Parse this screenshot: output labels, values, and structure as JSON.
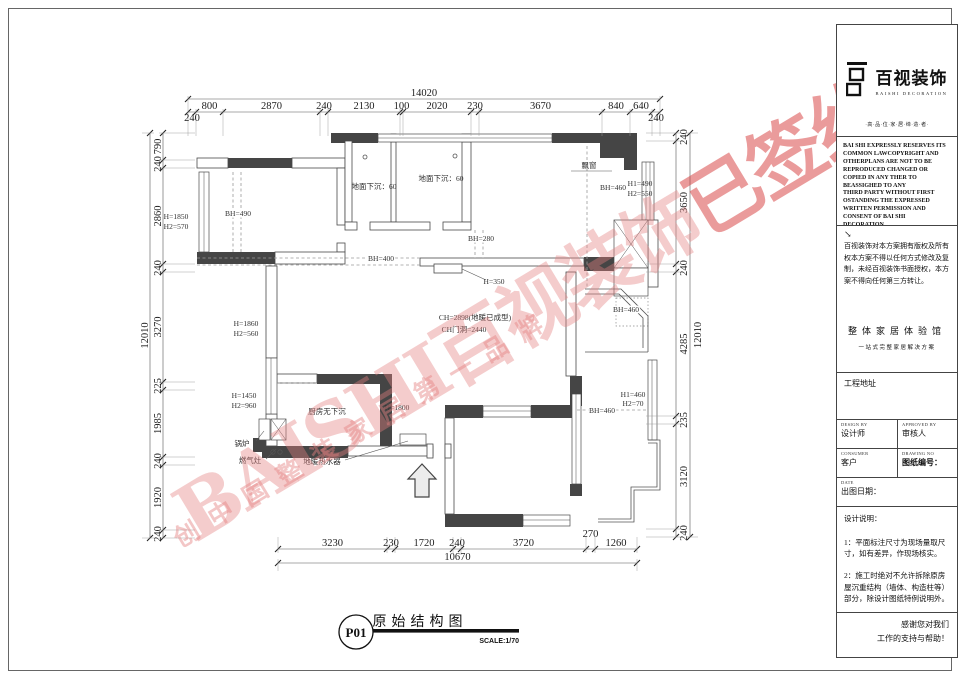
{
  "watermark": {
    "main": "BAISHI百视装饰",
    "stamp": "已签约",
    "sub": "创中国整装家居第一品牌"
  },
  "title_mark": {
    "code": "P01",
    "name": "原始结构图",
    "scale": "SCALE:1/70"
  },
  "sidebar": {
    "brand": "百视装饰",
    "brand_en": "BAISHI DECORATION",
    "tagline": "·高·品·位·家·居·缔·造·者·",
    "copyright_en": "BAI SHI EXPRESSLY RESERVES ITS\nCOMMON LAWCOPYRIGHT AND\nOTHERPLANS ARE NOT TO BE\nREPRODUCED CHANGED OR\nCOPIED IN ANY THER TO\nBEASSIGHED TO ANY\nTHIRD PARTY WITHOUT FIRST\nOSTANDING THE EXPRESSED\nWRITTEN PERMISSION AND\nCONSENT OF BAI SHI\nDECORATION",
    "arrow": "↘",
    "copyright_cn": "百视装饰对本方案拥有版权及所有权本方案不得以任何方式修改及复制，未经百视装饰书面授权，本方案不得向任何第三方转让。",
    "slogan1": "整体家居体验馆",
    "slogan2": "一站式完整家居解决方案",
    "project_address": "工程地址",
    "grid": [
      {
        "en": "DESIGN BY",
        "cn": "设计师",
        "cls": ""
      },
      {
        "en": "APPROVED BY",
        "cn": "审核人",
        "cls": "r"
      },
      {
        "en": "CONSUMER",
        "cn": "客户",
        "cls": ""
      },
      {
        "en": "DRAWING NO",
        "cn": "图纸编号：",
        "cls": "r b"
      },
      {
        "en": "DATE",
        "cn": "出图日期：",
        "cls": "span2"
      }
    ],
    "notes_title": "设计说明：",
    "notes": [
      "1：平面标注尺寸为现场量取尺寸，如有差异，作现场核实。",
      "2：施工时绝对不允许拆除原房屋沉重结构（墙体、构造柱等）部分，除设计图纸特例说明外。",
      "3：该图纸为施工图纸，双方（设计和甲方）签字认可后，方可作为施工依据。"
    ],
    "thanks": "感谢您对我们\n工作的支持与帮助！"
  },
  "plan": {
    "labels": [
      {
        "t": "地面下沉：60",
        "x": 374,
        "y": 189
      },
      {
        "t": "地面下沉：60",
        "x": 441,
        "y": 181
      },
      {
        "t": "BH=490",
        "x": 238,
        "y": 216,
        "cls": "bg"
      },
      {
        "t": "H=1850",
        "x": 176,
        "y": 219,
        "anchor": "start"
      },
      {
        "t": "H2=570",
        "x": 176,
        "y": 229,
        "anchor": "start"
      },
      {
        "t": "飘窗",
        "x": 589,
        "y": 168
      },
      {
        "t": "BH=460",
        "x": 613,
        "y": 190,
        "cls": "bg"
      },
      {
        "t": "H1=490",
        "x": 640,
        "y": 186,
        "anchor": "start"
      },
      {
        "t": "H2=550",
        "x": 640,
        "y": 196,
        "anchor": "start"
      },
      {
        "t": "BH=400",
        "x": 381,
        "y": 261,
        "cls": "bg"
      },
      {
        "t": "BH=280",
        "x": 481,
        "y": 241,
        "cls": "bg"
      },
      {
        "t": "H=350",
        "x": 494,
        "y": 284
      },
      {
        "t": "CH=2898(地暖已成型)",
        "x": 475,
        "y": 320
      },
      {
        "t": "CH门洞=2440",
        "x": 464,
        "y": 332
      },
      {
        "t": "BH=460",
        "x": 626,
        "y": 312,
        "cls": "bg"
      },
      {
        "t": "H1=460",
        "x": 633,
        "y": 397,
        "anchor": "start"
      },
      {
        "t": "H2=70",
        "x": 633,
        "y": 406,
        "anchor": "start"
      },
      {
        "t": "BH=460",
        "x": 602,
        "y": 413,
        "cls": "bg"
      },
      {
        "t": "H=1860",
        "x": 246,
        "y": 326,
        "anchor": "start"
      },
      {
        "t": "H2=560",
        "x": 246,
        "y": 336,
        "anchor": "start"
      },
      {
        "t": "H=1450",
        "x": 244,
        "y": 398,
        "anchor": "start"
      },
      {
        "t": "H2=960",
        "x": 244,
        "y": 408,
        "anchor": "start"
      },
      {
        "t": "厨房无下沉",
        "x": 327,
        "y": 414
      },
      {
        "t": "锅炉",
        "x": 242,
        "y": 446,
        "anchor": "start"
      },
      {
        "t": "燃气灶",
        "x": 250,
        "y": 463,
        "anchor": "start"
      },
      {
        "t": "地暖热水器",
        "x": 322,
        "y": 464
      },
      {
        "t": "H=1800",
        "x": 397,
        "y": 410,
        "anchor": "start"
      }
    ],
    "dims": {
      "top_overall": {
        "o": "h",
        "base": 99,
        "start": 188,
        "ext": [
          -3,
          10
        ],
        "segs": [
          [
            "14020",
            472
          ]
        ]
      },
      "top": {
        "o": "h",
        "base": 112,
        "start": 188,
        "ext": [
          -3,
          24
        ],
        "segs": [
          [
            "240",
            8,
            12
          ],
          [
            "800",
            27
          ],
          [
            "2870",
            97
          ],
          [
            "240",
            8
          ],
          [
            "2130",
            72
          ],
          [
            "100",
            3
          ],
          [
            "2020",
            68
          ],
          [
            "230",
            8
          ],
          [
            "3670",
            123
          ],
          [
            "840",
            28
          ],
          [
            "640",
            22
          ],
          [
            "240",
            8,
            12
          ]
        ]
      },
      "left": {
        "o": "v",
        "base": 163,
        "tx": 161,
        "start": 133,
        "ext": [
          -4,
          32
        ],
        "segs": [
          [
            "790",
            27
          ],
          [
            "240",
            8
          ],
          [
            "2860",
            96
          ],
          [
            "240",
            8
          ],
          [
            "3270",
            110
          ],
          [
            "225",
            8
          ],
          [
            "1985",
            67
          ],
          [
            "240",
            8
          ],
          [
            "1920",
            65
          ],
          [
            "240",
            8
          ]
        ]
      },
      "left_overall": {
        "o": "v",
        "base": 150,
        "tx": 148,
        "start": 133,
        "ext": [
          -8,
          4
        ],
        "segs": [
          [
            "12010",
            405
          ]
        ]
      },
      "right": {
        "o": "v",
        "base": 676,
        "tx": 687,
        "start": 133,
        "ext": [
          -30,
          4
        ],
        "segs": [
          [
            "240",
            8
          ],
          [
            "3650",
            123
          ],
          [
            "240",
            8
          ],
          [
            "4285",
            144
          ],
          [
            "235",
            8
          ],
          [
            "3120",
            105
          ],
          [
            "240",
            8
          ]
        ]
      },
      "right_overall": {
        "o": "v",
        "base": 690,
        "tx": 701,
        "start": 133,
        "ext": [
          -4,
          8
        ],
        "segs": [
          [
            "12010",
            404
          ]
        ]
      },
      "bottom": {
        "o": "h",
        "base": 549,
        "start": 278,
        "ext": [
          -12,
          4
        ],
        "segs": [
          [
            "3230",
            109
          ],
          [
            "230",
            8
          ],
          [
            "1720",
            58
          ],
          [
            "240",
            8
          ],
          [
            "3720",
            125
          ],
          [
            "270",
            9,
            -9
          ],
          [
            "1260",
            42
          ]
        ]
      },
      "bottom_overall": {
        "o": "h",
        "base": 563,
        "start": 278,
        "ext": [
          -4,
          8
        ],
        "segs": [
          [
            "10670",
            359
          ]
        ]
      }
    }
  }
}
